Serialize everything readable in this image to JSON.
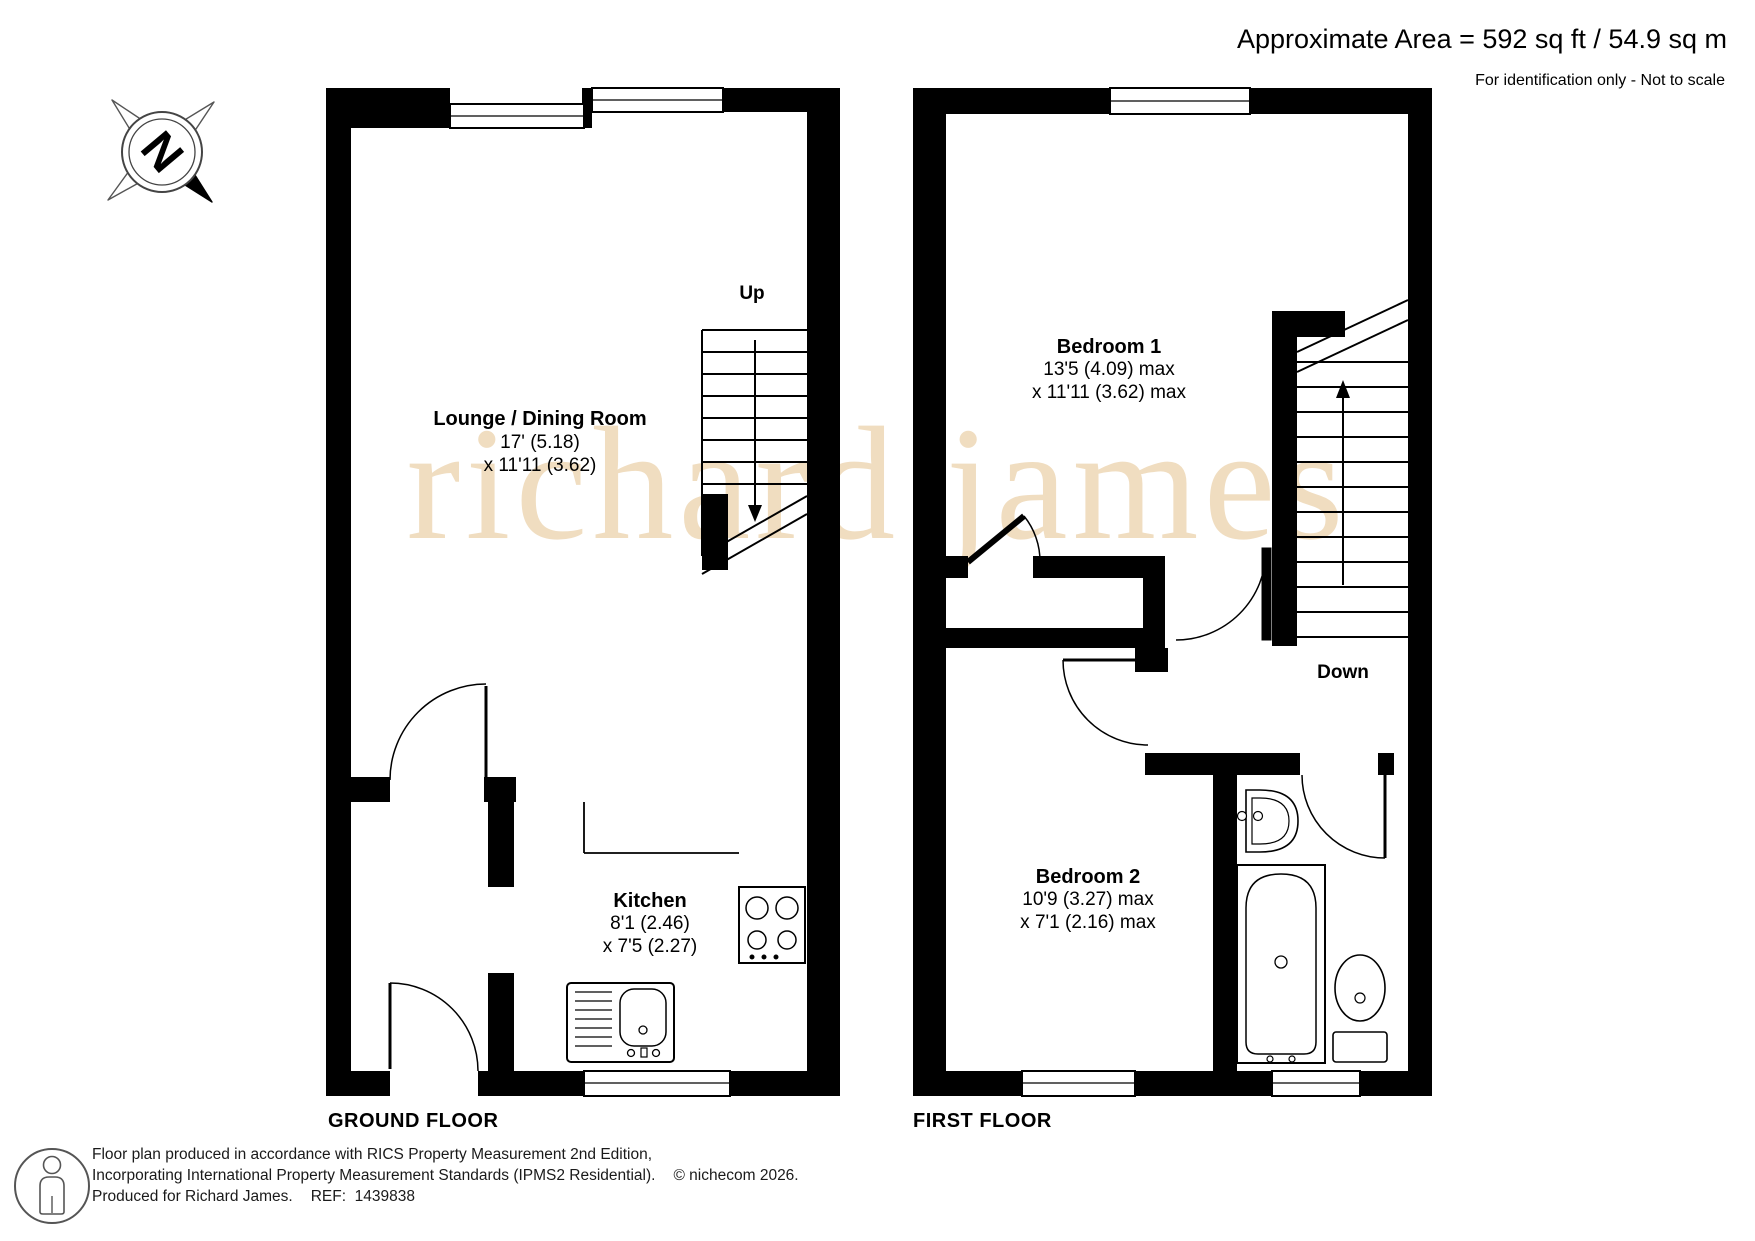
{
  "header": {
    "area_line": "Approximate Area = 592 sq ft / 54.9 sq m",
    "scale_line": "For identification only - Not to scale"
  },
  "watermark": {
    "text": "richard james",
    "color": "#f0ddc0"
  },
  "compass": {
    "letter": "N"
  },
  "floors": {
    "ground": {
      "title": "GROUND FLOOR",
      "stairs_label": "Up",
      "rooms": {
        "lounge": {
          "name": "Lounge / Dining Room",
          "dim1": "17' (5.18)",
          "dim2": "x 11'11 (3.62)"
        },
        "kitchen": {
          "name": "Kitchen",
          "dim1": "8'1 (2.46)",
          "dim2": "x 7'5 (2.27)"
        }
      }
    },
    "first": {
      "title": "FIRST FLOOR",
      "stairs_label": "Down",
      "rooms": {
        "bedroom1": {
          "name": "Bedroom 1",
          "dim1": "13'5 (4.09) max",
          "dim2": "x 11'11 (3.62) max"
        },
        "bedroom2": {
          "name": "Bedroom 2",
          "dim1": "10'9 (3.27) max",
          "dim2": "x 7'1 (2.16) max"
        }
      }
    }
  },
  "footer": {
    "line1": "Floor plan produced in accordance with RICS Property Measurement 2nd Edition,",
    "line2": "Incorporating International Property Measurement Standards (IPMS2 Residential).",
    "copyright": "© nichecom 2026.",
    "produced_for": "Produced for Richard James.",
    "ref_label": "REF:",
    "ref_value": "1439838"
  },
  "colors": {
    "wall": "#000000",
    "line": "#000000",
    "watermark": "#f0ddc0"
  }
}
